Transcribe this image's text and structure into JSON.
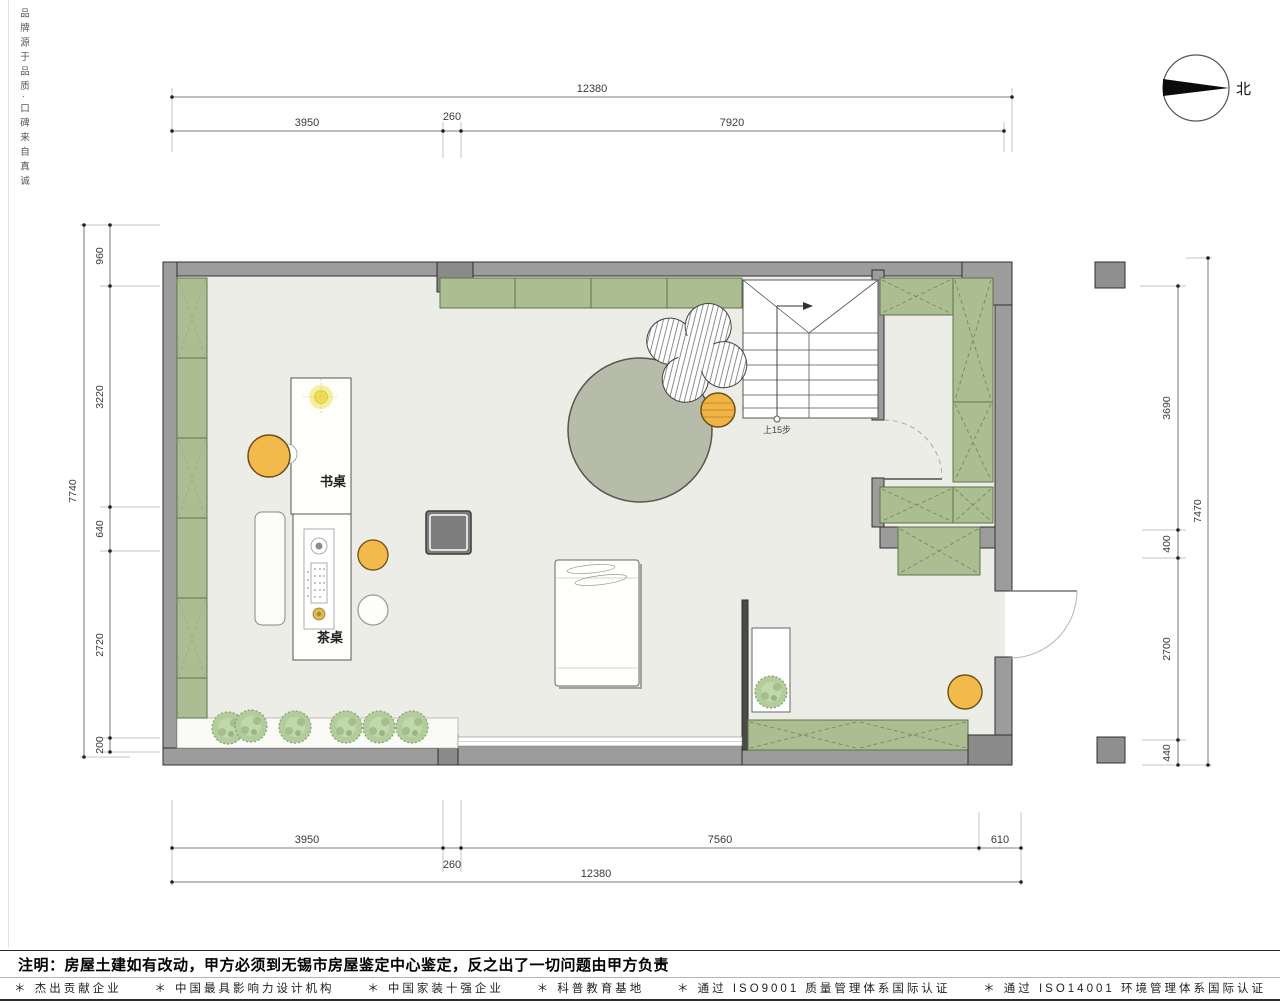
{
  "brand": {
    "side_text": "品牌源于品质·口碑来自真诚"
  },
  "compass": {
    "north_label": "北"
  },
  "plan_labels": {
    "desk": "书桌",
    "tea_table": "茶桌",
    "stairs_note": "上15步"
  },
  "dimensions": {
    "top": {
      "overall": "12380",
      "segments": [
        "3950",
        "260",
        "7920"
      ]
    },
    "bottom": {
      "overall": "12380",
      "segments": [
        "3950",
        "260",
        "7560",
        "610"
      ]
    },
    "left": {
      "overall": "7740",
      "segments": [
        "960",
        "3220",
        "640",
        "2720",
        "200"
      ]
    },
    "right": {
      "overall": "7470",
      "segments": [
        "3690",
        "400",
        "2700",
        "440"
      ]
    }
  },
  "notes": {
    "construction_note": "注明：房屋土建如有改动，甲方必须到无锡市房屋鉴定中心鉴定，反之出了一切问题由甲方负责"
  },
  "footer": {
    "items": [
      "＊ 杰出贡献企业",
      "＊ 中国最具影响力设计机构",
      "＊ 中国家装十强企业",
      "＊ 科普教育基地",
      "＊ 通过 ISO9001 质量管理体系国际认证",
      "＊ 通过 ISO14001 环境管理体系国际认证"
    ]
  },
  "colors": {
    "cabinet_green": "#abbe92",
    "wall_gray": "#9c9c9c",
    "floor": "#ecede7",
    "rug_gray_green": "#b7bba9",
    "accent_yellow": "#f2b94b"
  }
}
